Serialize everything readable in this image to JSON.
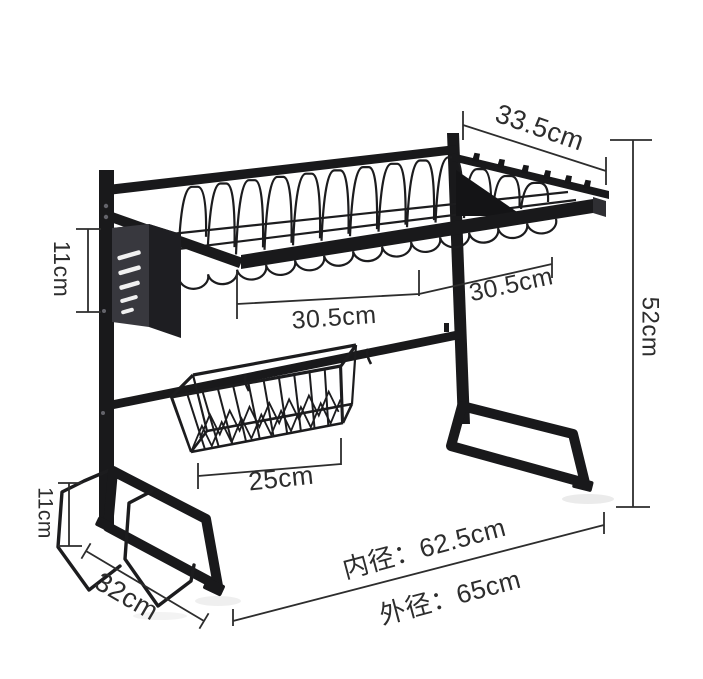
{
  "image": {
    "description": "Black over-sink dish drying rack shown on white background with dimension annotation lines",
    "background_color": "#ffffff",
    "rack_color": "#19191b",
    "dimension_line_color": "#2d2d2d"
  },
  "annotations": {
    "hook_rail_width": "33.5cm",
    "knife_holder_height": "11cm",
    "left_section_width": "30.5cm",
    "right_section_width": "30.5cm",
    "overall_height": "52cm",
    "basket_width": "25cm",
    "board_holder_height": "11cm",
    "foot_depth": "32cm",
    "inner_width": "内径：62.5cm",
    "outer_width": "外径：65cm"
  }
}
